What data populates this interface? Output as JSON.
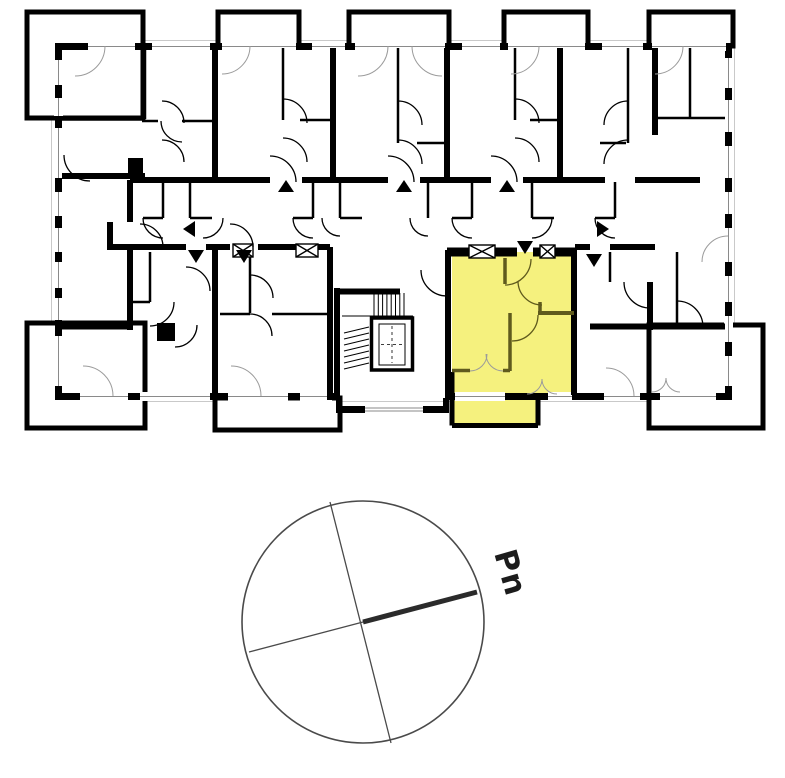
{
  "colors": {
    "background": "#ffffff",
    "walls": "#000000",
    "highlight_fill": "#f5f17e",
    "highlight_walls": "#5f5a1d",
    "thin_lines": "#9b9b9b",
    "footprint_outline": "#c9c9c9",
    "compass_stroke": "#4a4a4a",
    "needle_stroke": "#2b2b2b",
    "label_text": "#1c1c1c"
  },
  "compass": {
    "north_label": "Pn"
  }
}
